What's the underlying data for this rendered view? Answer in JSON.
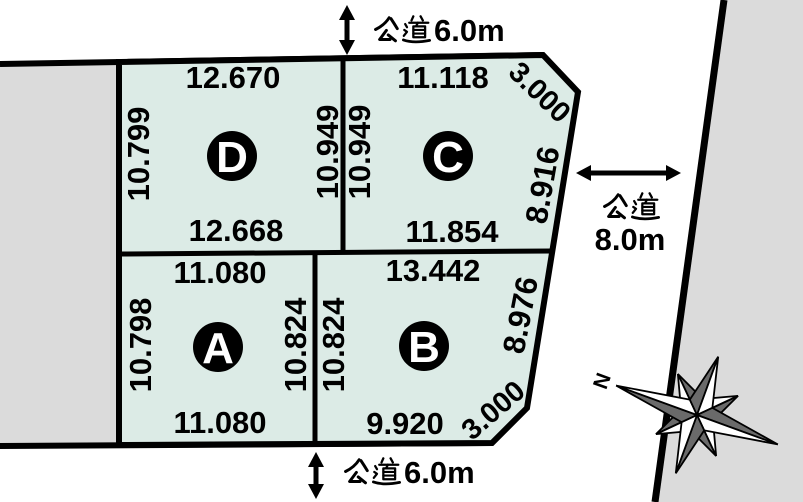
{
  "roads": {
    "top": {
      "label": "公道6.0m",
      "kanji": "公道",
      "width_text": "6.0m"
    },
    "bottom": {
      "label": "公道6.0m",
      "kanji": "公道",
      "width_text": "6.0m"
    },
    "right": {
      "label": "公道8.0m",
      "kanji": "公道",
      "width_text": "8.0m"
    }
  },
  "plots": [
    {
      "id": "D",
      "badge": "D",
      "top": "12.670",
      "bottom": "12.668",
      "left": "10.799",
      "right": "10.949"
    },
    {
      "id": "C",
      "badge": "C",
      "top": "11.118",
      "bottom": "11.854",
      "left": "10.949",
      "right": "8.916",
      "corner": "3.000"
    },
    {
      "id": "A",
      "badge": "A",
      "top": "11.080",
      "bottom": "11.080",
      "left": "10.798",
      "right": "10.824"
    },
    {
      "id": "B",
      "badge": "B",
      "top": "13.442",
      "bottom": "9.920",
      "left": "10.824",
      "right": "8.976",
      "corner": "3.000"
    }
  ],
  "compass": {
    "north_label": "N"
  },
  "colors": {
    "plot_fill": "#dcebe6",
    "adjacent_fill": "#dbdbdb",
    "line": "#000000",
    "compass_dark": "#6a6a6a",
    "background": "#ffffff"
  }
}
